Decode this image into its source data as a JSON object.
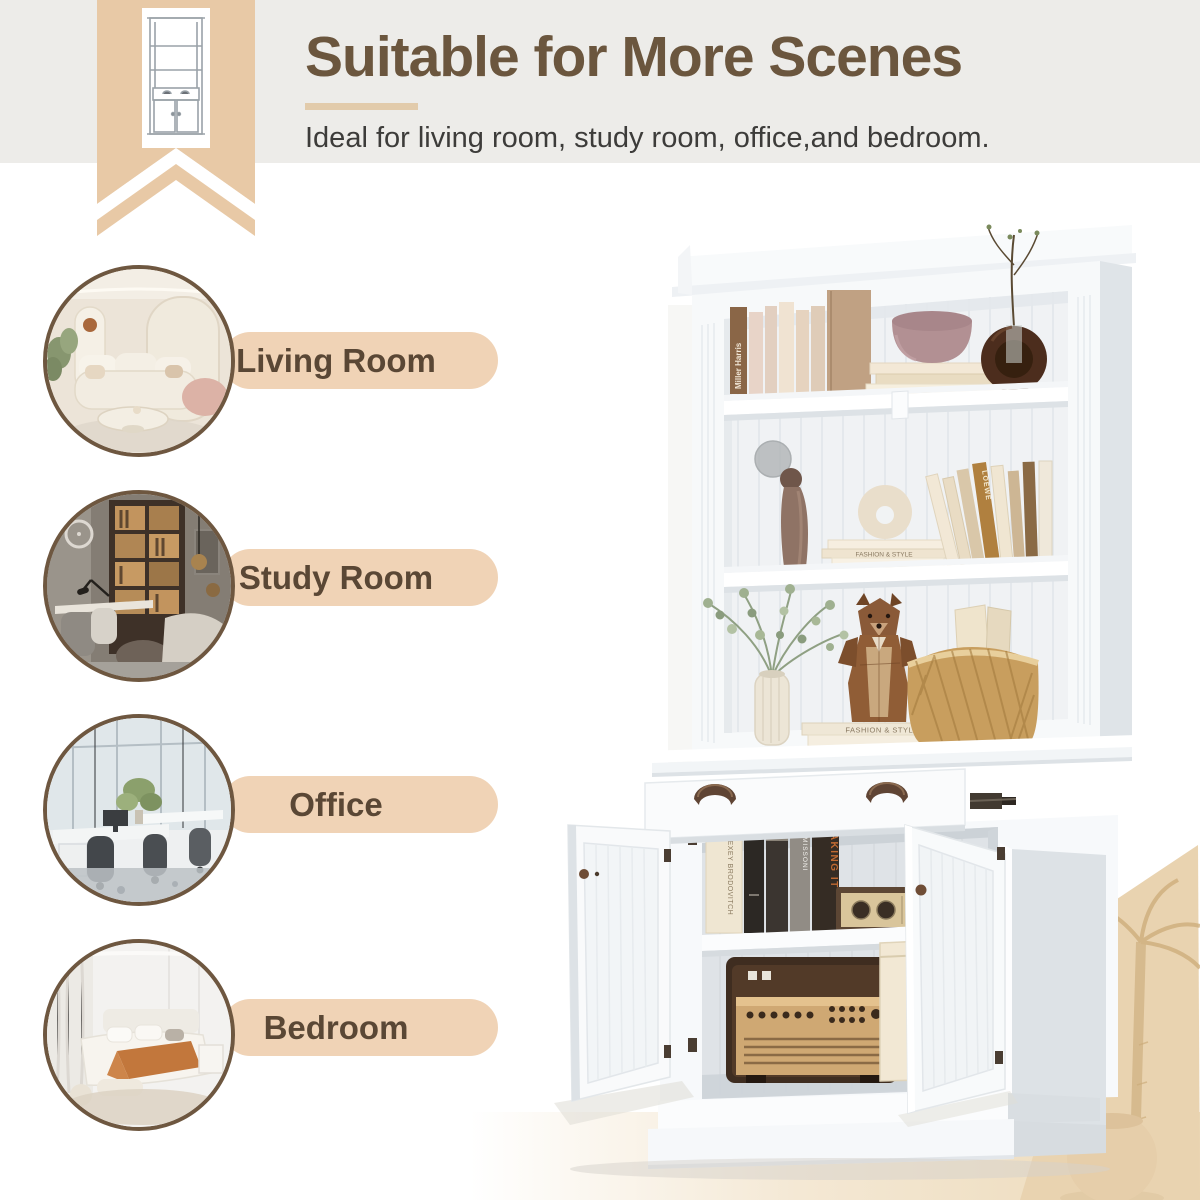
{
  "header": {
    "title": "Suitable for More Scenes",
    "subtitle": "Ideal for living room, study room, office,and bedroom."
  },
  "scenes": [
    {
      "id": "living-room",
      "label": "Living Room"
    },
    {
      "id": "study-room",
      "label": "Study Room"
    },
    {
      "id": "office",
      "label": "Office"
    },
    {
      "id": "bedroom",
      "label": "Bedroom"
    }
  ],
  "product": {
    "description": "White bookshelf hutch with open shelves, drawer and two-door cabinet",
    "book_spine_texts": {
      "miller_harris": "Miller Harris",
      "fashion_style": "FASHION & STYLE",
      "making_it": "MAKING IT",
      "missoni": "MISSONI",
      "alexey": "ALEXEY BRODOVITCH",
      "loewe": "LOEWE"
    }
  },
  "colors": {
    "band_gray": "#edece9",
    "ribbon_tan": "#e8c9a6",
    "pill_tan": "#f0d3b6",
    "title_brown": "#6b563e",
    "label_brown": "#5a4735",
    "circle_border": "#6e5740",
    "corner_beige": "#e9d3b0"
  }
}
